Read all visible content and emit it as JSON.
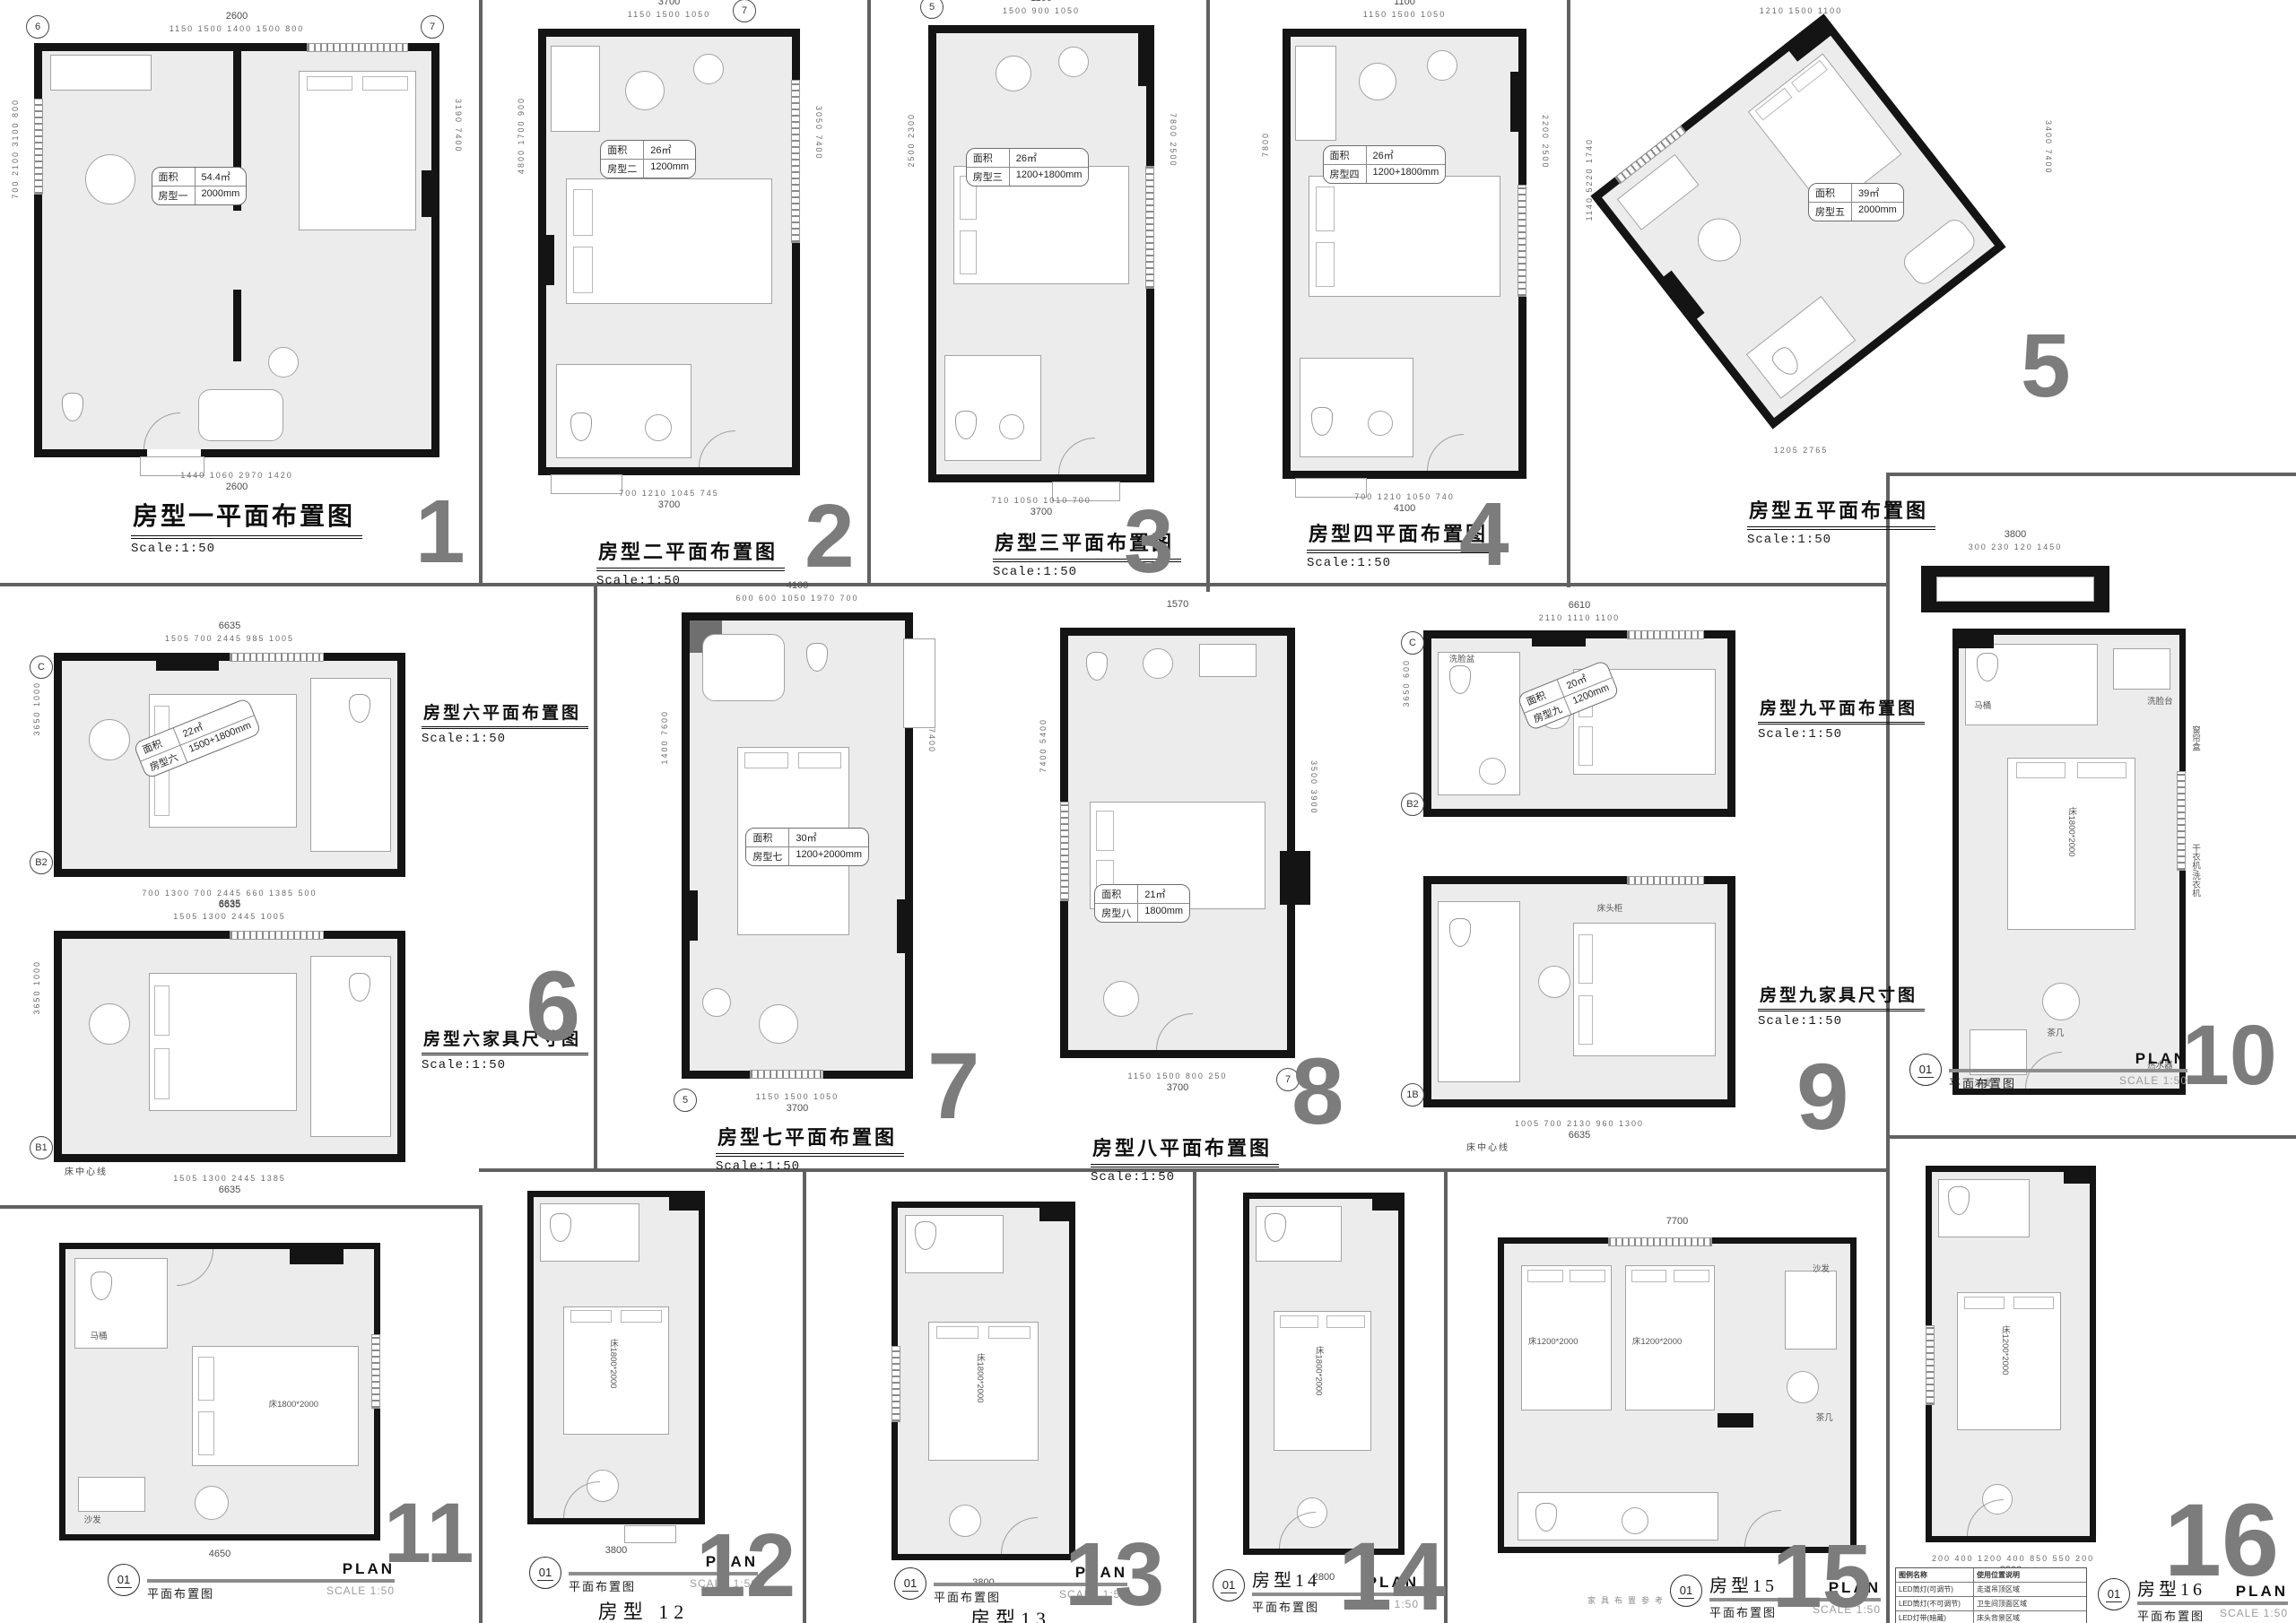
{
  "sheet": {
    "background": "#ffffff",
    "wall_color": "#141414",
    "room_fill": "#ececec",
    "number_color": "#7c7c7c",
    "divider_color": "#616161"
  },
  "plans": [
    {
      "number": "1",
      "title": "房型一平面布置图",
      "scale": "Scale:1:50",
      "area": {
        "l1": "面积",
        "v1": "54.4㎡",
        "l2": "房型一",
        "v2": "2000mm"
      },
      "dims": {
        "tt": "2600",
        "t": "1150  1500  1400  1500  800",
        "b": "1440  1060  2970  1420",
        "bt": "2600",
        "l": "700  2100  3100  800",
        "r": "3190  7400"
      },
      "markers": [
        "6",
        "7"
      ]
    },
    {
      "number": "2",
      "title": "房型二平面布置图",
      "scale": "Scale:1:50",
      "area": {
        "l1": "面积",
        "v1": "26㎡",
        "l2": "房型二",
        "v2": "1200mm"
      },
      "dims": {
        "tt": "3700",
        "t": "1150  1500  1050",
        "b": "700  1210  1045  745",
        "bt": "3700",
        "l": "4800  1700  900",
        "r": "3050  7400"
      },
      "markers": [
        "7"
      ]
    },
    {
      "number": "3",
      "title": "房型三平面布置图",
      "scale": "Scale:1:50",
      "area": {
        "l1": "面积",
        "v1": "26㎡",
        "l2": "房型三",
        "v2": "1200+1800mm"
      },
      "dims": {
        "tt": "1100",
        "t": "1500  900  1050",
        "b": "710  1050  1010  700",
        "bt": "3700",
        "l": "2500  2300",
        "r": "7800  2500"
      },
      "markers": [
        "5"
      ]
    },
    {
      "number": "4",
      "title": "房型四平面布置图",
      "scale": "Scale:1:50",
      "area": {
        "l1": "面积",
        "v1": "26㎡",
        "l2": "房型四",
        "v2": "1200+1800mm"
      },
      "dims": {
        "tt": "1100",
        "t": "1150  1500  1050",
        "b": "700  1210  1050  740",
        "bt": "4100",
        "l": "7800",
        "r": "2200  2500"
      },
      "markers": []
    },
    {
      "number": "5",
      "title": "房型五平面布置图",
      "scale": "Scale:1:50",
      "area": {
        "l1": "面积",
        "v1": "39㎡",
        "l2": "房型五",
        "v2": "2000mm"
      },
      "dims": {
        "t": "1210  1500  1100",
        "l": "1140  5220  1740",
        "r": "3400  7400",
        "b": "1205  2765"
      },
      "markers": []
    },
    {
      "number": "6",
      "title": "房型六平面布置图",
      "scale": "Scale:1:50",
      "title2": "房型六家具尺寸图",
      "scale2": "Scale:1:50",
      "area": {
        "l1": "面积",
        "v1": "22㎡",
        "l2": "房型六",
        "v2": "1500+1800mm"
      },
      "dims": {
        "tt": "6635",
        "t": "1505  700  2445  985  1005",
        "b": "700  1300  700  2445  660  1385  500",
        "bt": "6635",
        "l": "3650  1000"
      },
      "dims2": {
        "tt": "6635",
        "t": "1505  1300  2445  1005",
        "b": "1505  1300  2445  1385",
        "bt": "6635",
        "l": "3650  1000"
      },
      "note": "床中心线",
      "markers": [
        "C",
        "B2",
        "B1"
      ]
    },
    {
      "number": "7",
      "title": "房型七平面布置图",
      "scale": "Scale:1:50",
      "area": {
        "l1": "面积",
        "v1": "30㎡",
        "l2": "房型七",
        "v2": "1200+2000mm"
      },
      "dims": {
        "tt": "4100",
        "t": "600  600  1050  1970  700",
        "b": "1150  1500  1050",
        "bt": "3700",
        "l": "1400  7600",
        "r": "7400"
      },
      "markers": [
        "5"
      ]
    },
    {
      "number": "8",
      "title": "房型八平面布置图",
      "scale": "Scale:1:50",
      "area": {
        "l1": "面积",
        "v1": "21㎡",
        "l2": "房型八",
        "v2": "1800mm"
      },
      "dims": {
        "t": "1570",
        "b": "1150  1500  800  250",
        "bt": "3700",
        "l": "7400  5400",
        "r": "3500  3900"
      },
      "markers": [
        "7"
      ]
    },
    {
      "number": "9",
      "title": "房型九平面布置图",
      "scale": "Scale:1:50",
      "title2": "房型九家具尺寸图",
      "scale2": "Scale:1:50",
      "area": {
        "l1": "面积",
        "v1": "20㎡",
        "l2": "房型九",
        "v2": "1200mm"
      },
      "dims": {
        "tt": "6610",
        "t": "2110  1110  1100",
        "b": "1005  700  2130  960  1300",
        "bt": "6635",
        "l": "3650  600"
      },
      "note": "床中心线",
      "markers": [
        "C",
        "B2",
        "1B"
      ],
      "furniture": [
        "洗脸盆",
        "床头柜"
      ]
    },
    {
      "number": "10",
      "tb": {
        "num": "01",
        "cn": "平面布置图",
        "en": "PLAN",
        "scale": "SCALE 1:50"
      },
      "furniture": [
        "马桶",
        "洗脸台",
        "床1800*2000",
        "茶几",
        "沙发",
        "热水器"
      ],
      "side_labels": [
        "窗帘盒",
        "干衣机/洗衣机"
      ],
      "detail": {
        "tt": "3800",
        "t": "300  230  120  1450"
      }
    },
    {
      "number": "11",
      "tb": {
        "num": "01",
        "cn": "平面布置图",
        "en": "PLAN",
        "scale": "SCALE 1:50"
      },
      "furniture": [
        "马桶",
        "床1800*2000",
        "沙发"
      ],
      "dims": {
        "bt": "4650"
      }
    },
    {
      "number": "12",
      "tb": {
        "num": "01",
        "cn": "平面布置图",
        "en": "PLAN",
        "scale": "SCALE 1:50",
        "name": "房型 12"
      },
      "furniture": [
        "床1800*2000"
      ],
      "dims": {
        "bt": "3800"
      }
    },
    {
      "number": "13",
      "tb": {
        "num": "01",
        "cn": "平面布置图",
        "en": "PLAN",
        "scale": "SCALE 1:50",
        "name": "房型13"
      },
      "furniture": [
        "床1800*2000"
      ],
      "dims": {
        "bt": "3800"
      }
    },
    {
      "number": "14",
      "tb": {
        "num": "01",
        "cn": "平面布置图",
        "en": "PLAN",
        "scale": "SCALE 1:50",
        "name": "房型14"
      },
      "furniture": [
        "床1800*2000"
      ],
      "dims": {
        "bt": "2800"
      },
      "caption": "家具布置参考"
    },
    {
      "number": "15",
      "tb": {
        "num": "01",
        "cn": "平面布置图",
        "en": "PLAN",
        "scale": "SCALE 1:50",
        "name": "房型15"
      },
      "furniture": [
        "床1200*2000",
        "床1200*2000",
        "沙发",
        "茶几"
      ],
      "dims": {
        "tt": "7700"
      }
    },
    {
      "number": "16",
      "tb": {
        "num": "01",
        "cn": "平面布置图",
        "en": "PLAN",
        "scale": "SCALE 1:50",
        "name": "房型16"
      },
      "furniture": [
        "床1200*2000"
      ],
      "dims": {
        "b": "200  400  1200  400  850  550  200",
        "bt": "3800"
      },
      "legend": {
        "headers": [
          "图例名称",
          "使用位置说明"
        ],
        "rows": [
          [
            "LED筒灯(可调节)",
            "走道吊顶区域"
          ],
          [
            "LED筒灯(不可调节)",
            "卫生间顶面区域"
          ],
          [
            "LED灯带(暗藏)",
            "床头背景区域"
          ]
        ]
      }
    }
  ]
}
